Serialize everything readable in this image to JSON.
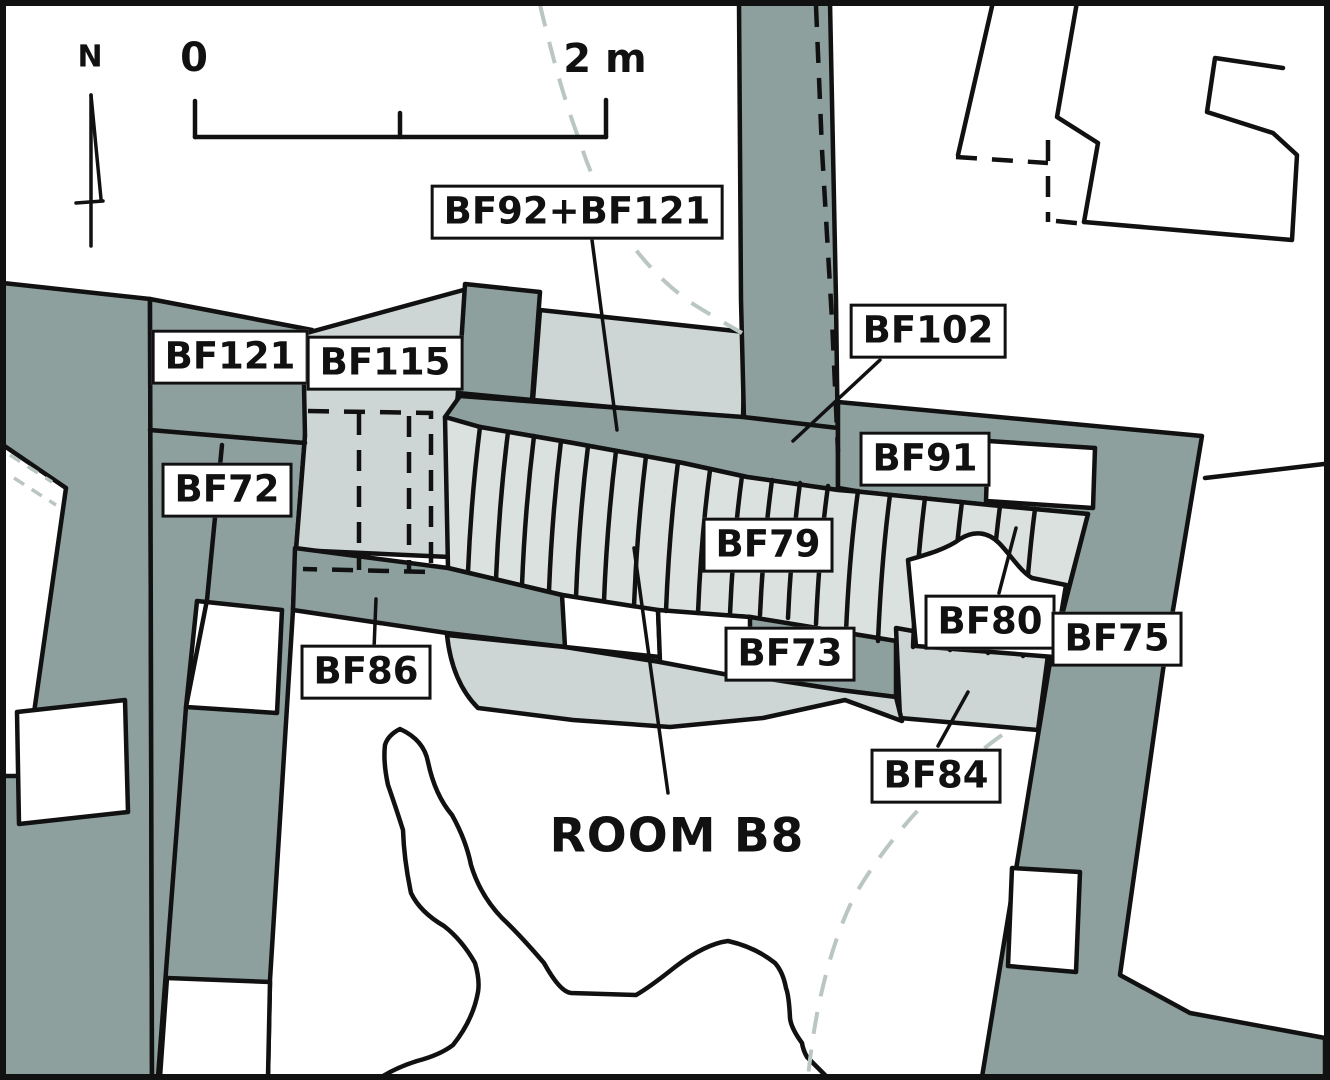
{
  "colors": {
    "wall": "#8da09e",
    "floor_segments": "#dae1df",
    "floor_light": "#cdd6d4",
    "outline": "#111111",
    "dashed_arc": "#bac6c4",
    "paper": "#ffffff"
  },
  "compass": {
    "north_label": "N"
  },
  "scale_bar": {
    "start_label": "0",
    "end_label": "2 m"
  },
  "room": {
    "label": "ROOM B8"
  },
  "labels": {
    "bf92_bf121": "BF92+BF121",
    "bf121": "BF121",
    "bf115": "BF115",
    "bf72": "BF72",
    "bf102": "BF102",
    "bf91": "BF91",
    "bf79": "BF79",
    "bf80": "BF80",
    "bf75": "BF75",
    "bf73": "BF73",
    "bf86": "BF86",
    "bf84": "BF84"
  }
}
